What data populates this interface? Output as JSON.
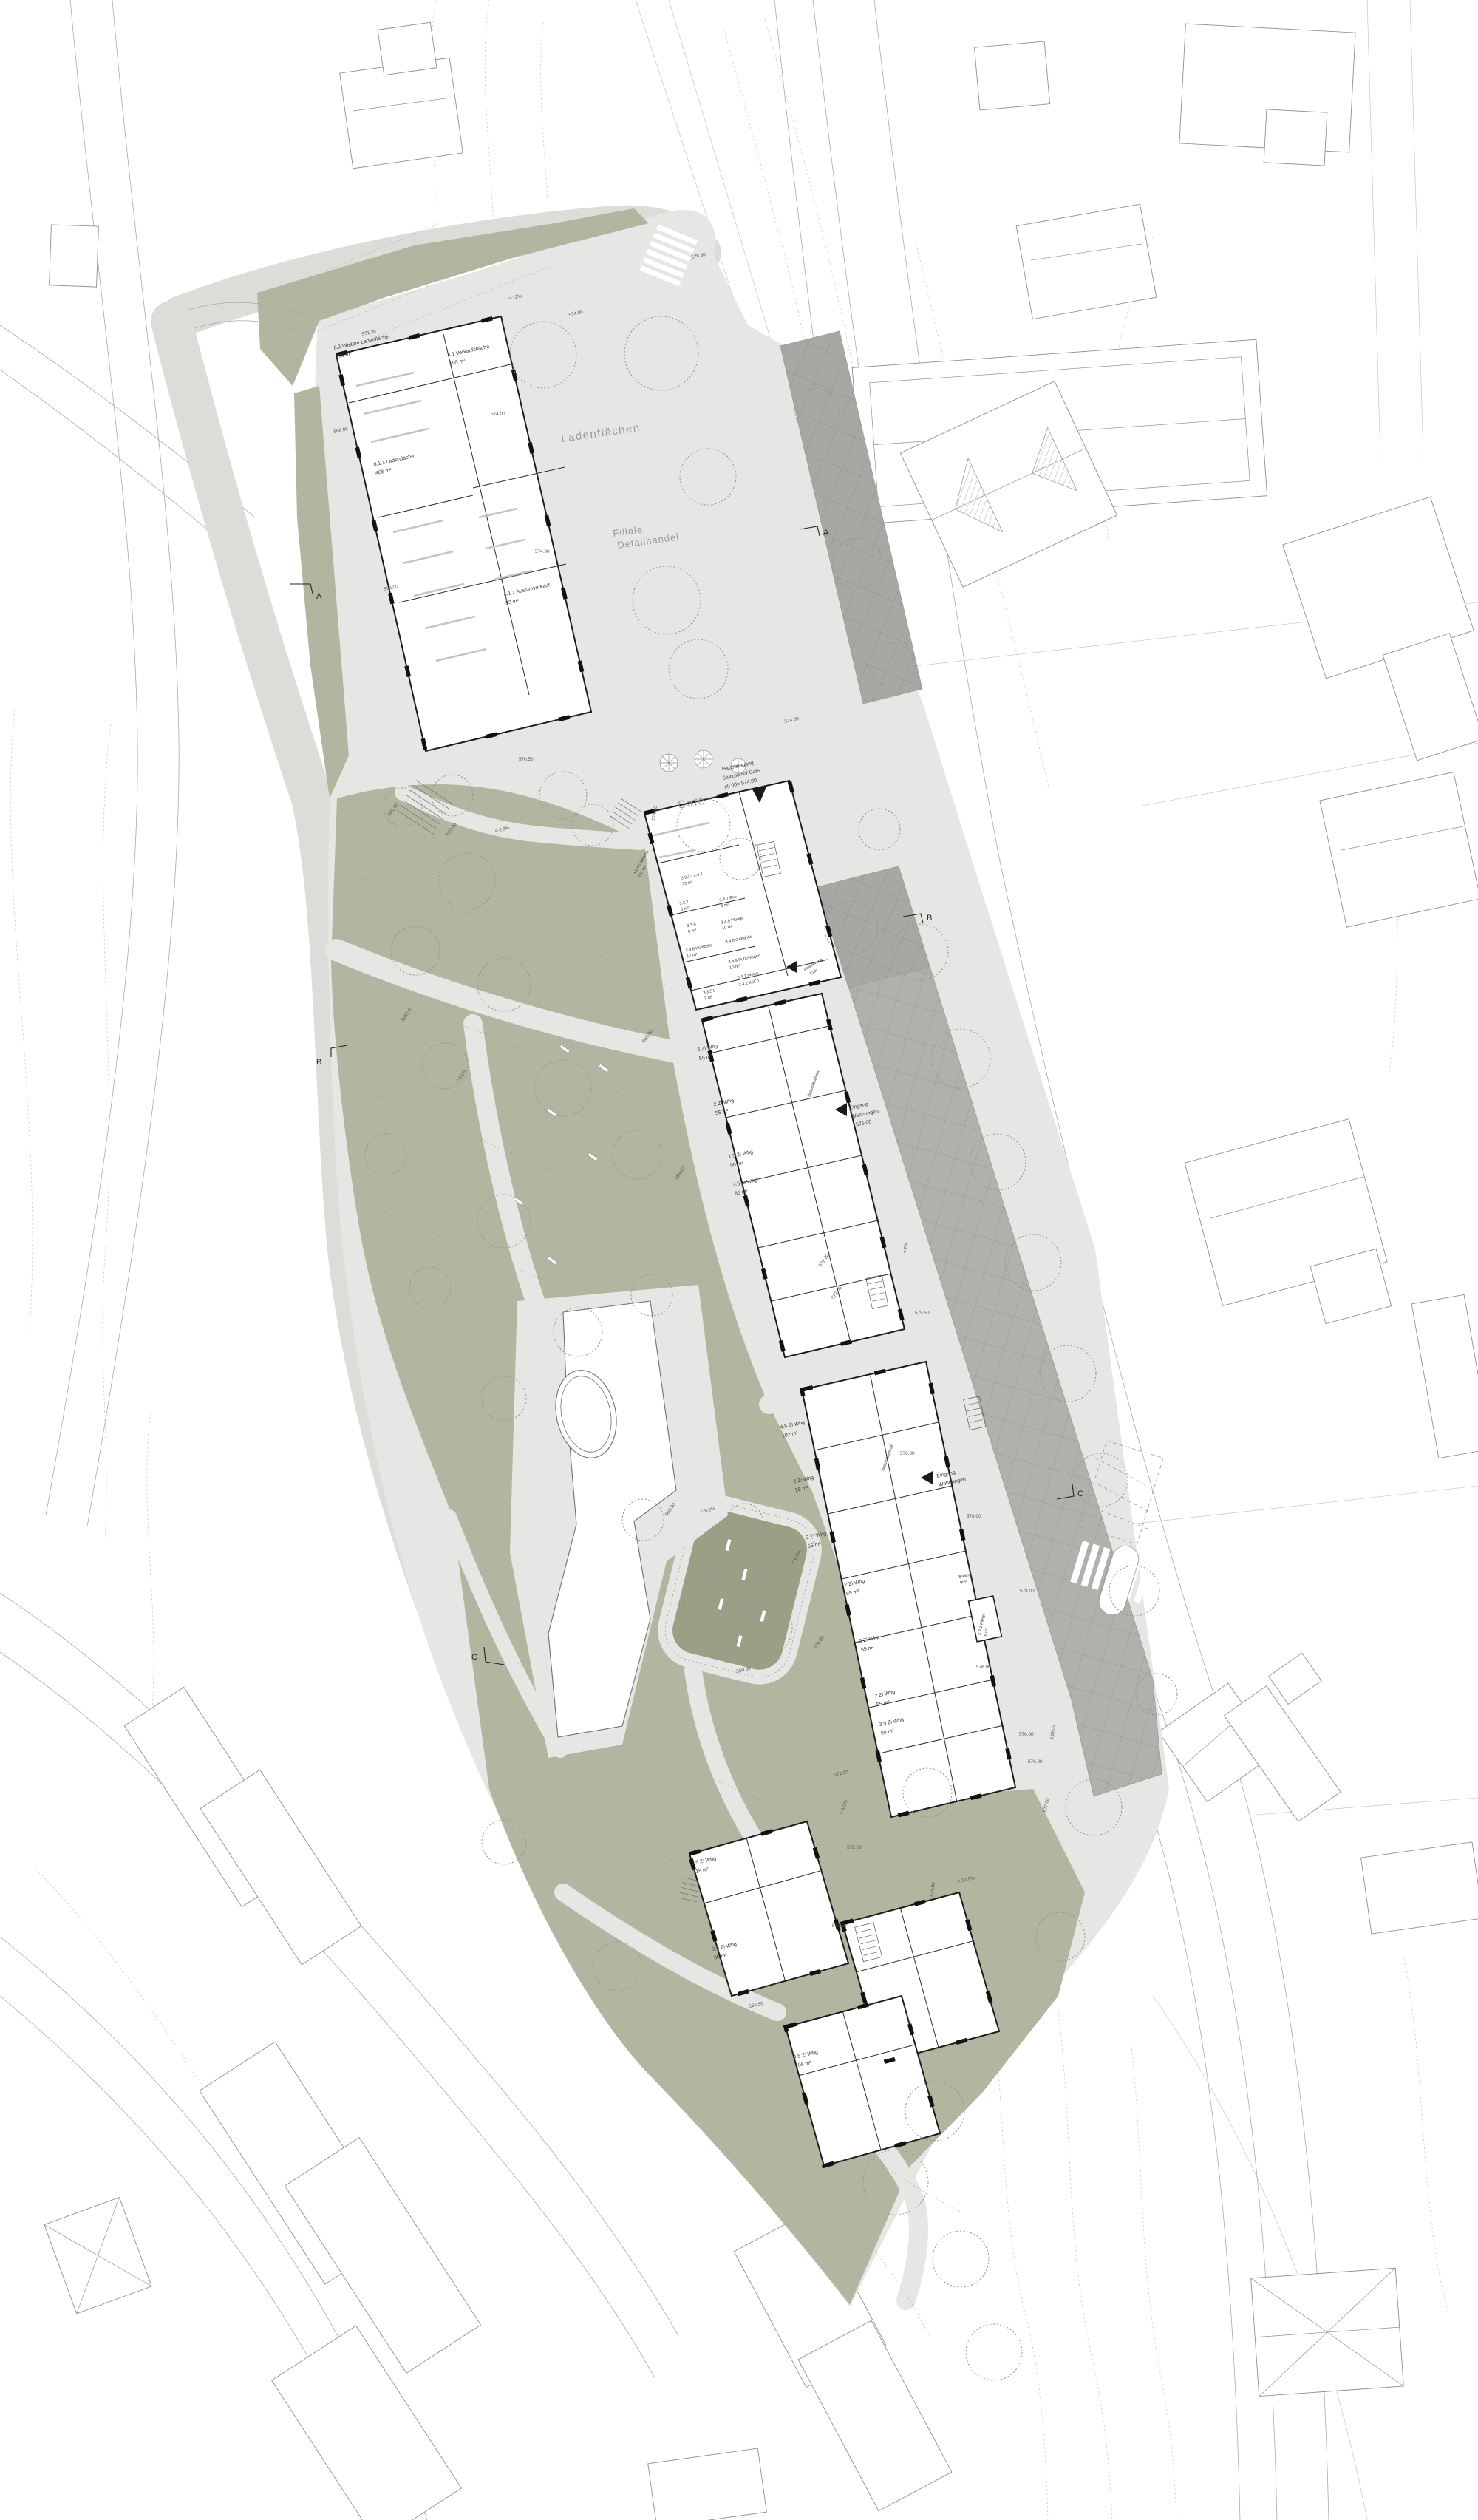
{
  "colors": {
    "background": "#ffffff",
    "site_paving": "#e6e7e4",
    "landscape_green": "#b2b6a0",
    "playground_green": "#99a085",
    "parking_grey": "#b0b1ad",
    "building_wall": "#1d1d1d",
    "context_line": "#a9a9a9",
    "big_label_grey": "#97999b"
  },
  "labels_big": {
    "ladenflaechen": "Ladenflächen",
    "filiale_line1": "Filiale",
    "filiale_line2": "Detailhandel",
    "cafe": "Cafe"
  },
  "sections": {
    "a": "A",
    "b": "B",
    "c": "C"
  },
  "retail": {
    "r1a": "6.2 Weitere Ladenfläche",
    "r1b": "191 m²",
    "r2a": "6.1 Verkaufsfläche",
    "r2b": "155 m²",
    "r3a": "6.1.1 Ladenfläche",
    "r3b": "466 m²",
    "r4a": "6.1.2 Aussenverkauf",
    "r4b": "83 m²"
  },
  "cafe_rooms": {
    "k1a": "3.3.4 Cafeteria",
    "k1b": "137 m²",
    "k2a": "3.3.3 / 3.4.4",
    "k2b": "33 m²",
    "k3": "3.3.7",
    "k3b": "8 m²",
    "k4": "3.3.6",
    "k4b": "8 m²",
    "k5a": "3.4.6 Kühlzelle",
    "k5b": "17 m²",
    "k6a": "3.4.7 Eco",
    "k6b": "6 m²",
    "k7a": "3.4.5 Plonge",
    "k7b": "10 m²",
    "k8": "3.4.8 Getränke",
    "k9a": "3.4.9 Putz/Wagen",
    "k9b": "10 m²",
    "k10": "3.4.1 WaKo",
    "k11": "3.4.2 KüCh",
    "k12a": "3.3.5 L",
    "k12b": "7 m²"
  },
  "apartments": {
    "whg2": "2 Zi Whg",
    "m55": "55 m²",
    "whg15": "1.5 Zi Whg",
    "m50": "50 m²",
    "whg35": "3.5 Zi Whg",
    "m85": "85 m²",
    "m80": "80 m²",
    "m88": "88 m²",
    "whg45": "4.5 Zi Whg",
    "m102": "102 m²",
    "m106": "106 m²",
    "whg55": "5.5 Zi Whg",
    "m118": "118 m²",
    "balkon": "Balkon",
    "m9": "9m²",
    "pflege": "2.2.1 Pflege",
    "m6": "6 m²",
    "brand": "Brandabschnitt"
  },
  "entrances": {
    "haupt1": "Haupteingang",
    "haupt2": "Stützpunkt/ Cafe",
    "haupt3": "±0.00= 574.00",
    "eingang1": "Eingang",
    "eingang2": "Wohnungen",
    "anlieferung1": "Anlieferung",
    "anlieferung2": "Cafe"
  },
  "site_labels": {
    "e566": "566.00",
    "e566_5": "566.50",
    "e568": "568.00",
    "e569": "569.00",
    "e570": "570.00",
    "e570_5": "570.50",
    "e571": "571.00",
    "e571_3": "571.30",
    "e572": "572.00",
    "e572_5": "572.50",
    "e573": "573.00",
    "e574": "574.00",
    "e575": "575.00",
    "e575_3": "575.30",
    "e575_5": "575.50",
    "e576": "576.00",
    "e577": "577.00",
    "e578": "578.00",
    "s12": "<-12%",
    "s12_0": "<-12.0%",
    "s2": "<-2%",
    "s2_3": "<-2.3%",
    "s6": "<-6.0%",
    "s6r": "6.0%->",
    "s8": "<-8.0%",
    "s9": "<-9.0%"
  }
}
